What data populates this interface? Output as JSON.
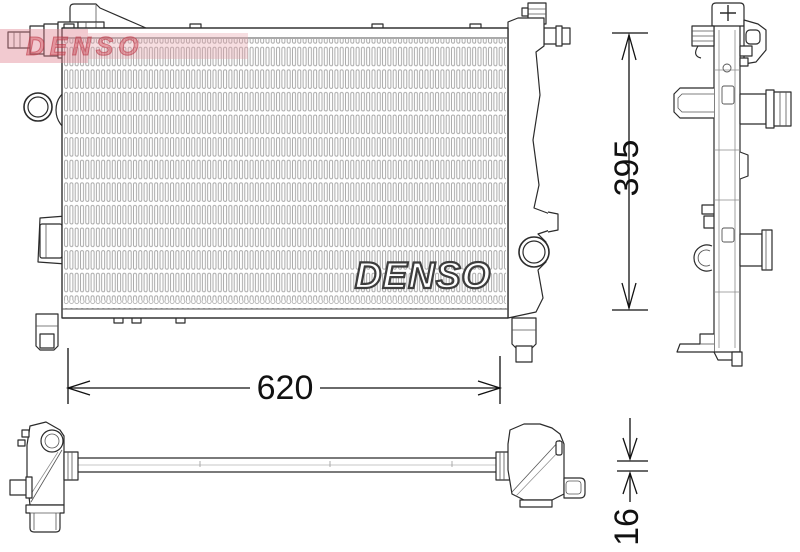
{
  "watermark": {
    "text": "DENSO"
  },
  "core_logo": {
    "text": "DENSO"
  },
  "dimensions": {
    "width_mm": "620",
    "height_mm": "395",
    "core_thickness_mm": "16"
  },
  "colors": {
    "line": "#2b2b2b",
    "detail_line": "#555555",
    "fin_line": "#a2a2a2",
    "dimension_line": "#111111",
    "watermark_pink": "#eec0c6",
    "watermark_red": "#c9556a",
    "background": "#ffffff"
  }
}
